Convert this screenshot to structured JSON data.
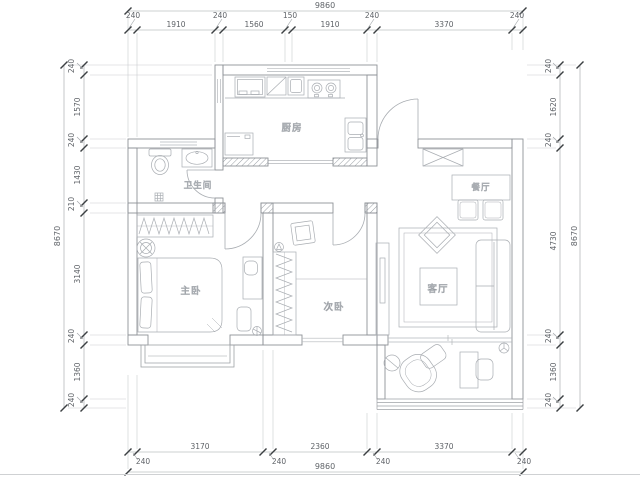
{
  "drawing": {
    "type": "apartment floor plan",
    "rooms": {
      "kitchen": "厨房",
      "bathroom": "卫生间",
      "master_bedroom": "主卧",
      "second_bedroom": "次卧",
      "living_room": "客厅",
      "dining_room": "餐厅"
    },
    "dims": {
      "top": {
        "total": "9860",
        "segs": [
          "240",
          "1910",
          "240",
          "1560",
          "150",
          "1910",
          "240",
          "3370",
          "240"
        ]
      },
      "bottom": {
        "total": "9860",
        "segs": [
          "240",
          "3170",
          "240",
          "2360",
          "240",
          "3370",
          "240"
        ]
      },
      "left": {
        "total": "8670",
        "segs": [
          "240",
          "1570",
          "240",
          "1430",
          "210",
          "3140",
          "240",
          "1360",
          "240"
        ]
      },
      "right": {
        "total": "8670",
        "segs": [
          "240",
          "1620",
          "240",
          "4730",
          "240",
          "1360",
          "240"
        ]
      }
    },
    "colors": {
      "wall": "#8e9297",
      "furniture": "#a9adb2",
      "dim_line": "#9ea2a6",
      "tick": "#3c4043",
      "dim_text": "#5f6368",
      "label_text": "#3c4043",
      "ext_line": "#c9cccf",
      "bg": "#ffffff"
    }
  }
}
